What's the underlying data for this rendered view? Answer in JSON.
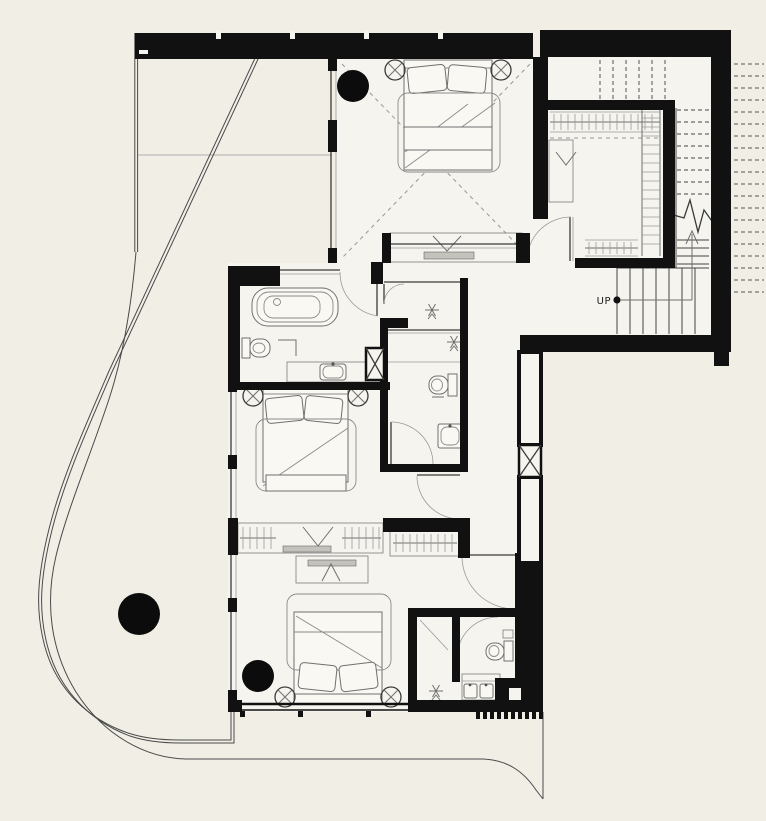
{
  "meta": {
    "drawing_type": "architectural floor plan, upper storey",
    "visible_text": [
      "UP"
    ]
  },
  "labels": {
    "up": "UP"
  },
  "colors": {
    "background": "#f1eee6",
    "floor": "#f6f4ee",
    "wall": "#111111",
    "thin_line": "#3a3a3a",
    "furniture_line": "#707070",
    "shelf_gray": "#c3c2bb"
  },
  "inventory": {
    "bedrooms": 3,
    "beds": 3,
    "bedside_lamps": 6,
    "structural_columns": 3,
    "bathtubs": 1,
    "toilets": 3,
    "sinks_basins": 4,
    "floor_drain_symbols": 3,
    "wardrobe_runs": 4,
    "stair_flights": 2,
    "duct_shafts": 2,
    "doors": 8
  }
}
